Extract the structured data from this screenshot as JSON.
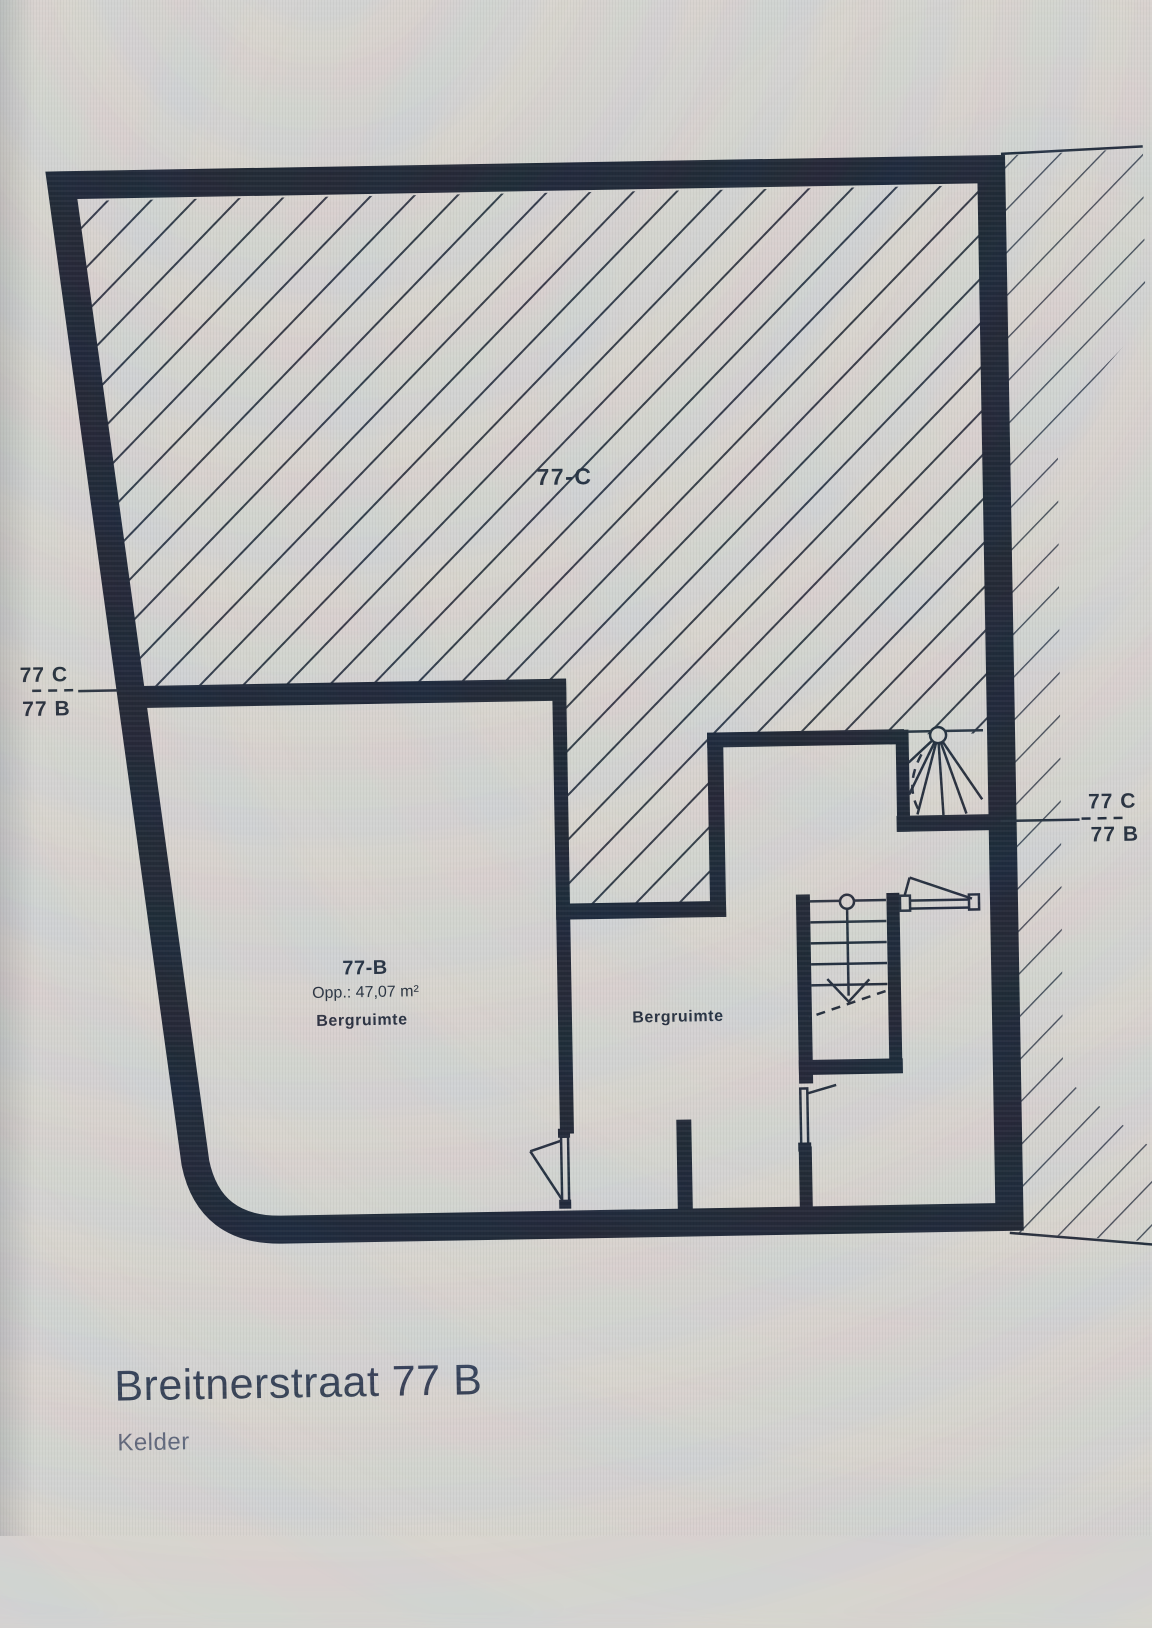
{
  "plan": {
    "title": "Breitnerstraat 77 B",
    "subtitle": "Kelder",
    "units": {
      "c": {
        "label": "77-C"
      },
      "b": {
        "label": "77-B",
        "area": "Opp.: 47,07 m²",
        "room": "Bergruimte"
      },
      "middle": {
        "room": "Bergruimte"
      }
    },
    "section_markers": {
      "left": {
        "top": "77 C",
        "bottom": "77 B"
      },
      "right": {
        "top": "77 C",
        "bottom": "77 B"
      }
    },
    "colors": {
      "wall": "#17202f",
      "hatch_interior": "#2c3442",
      "hatch_exterior": "#3e4654",
      "label_text": "#1f2938",
      "title_text": "#2f3a50",
      "subtitle_text": "#5a6478",
      "paper": "#d6d4d0"
    }
  }
}
